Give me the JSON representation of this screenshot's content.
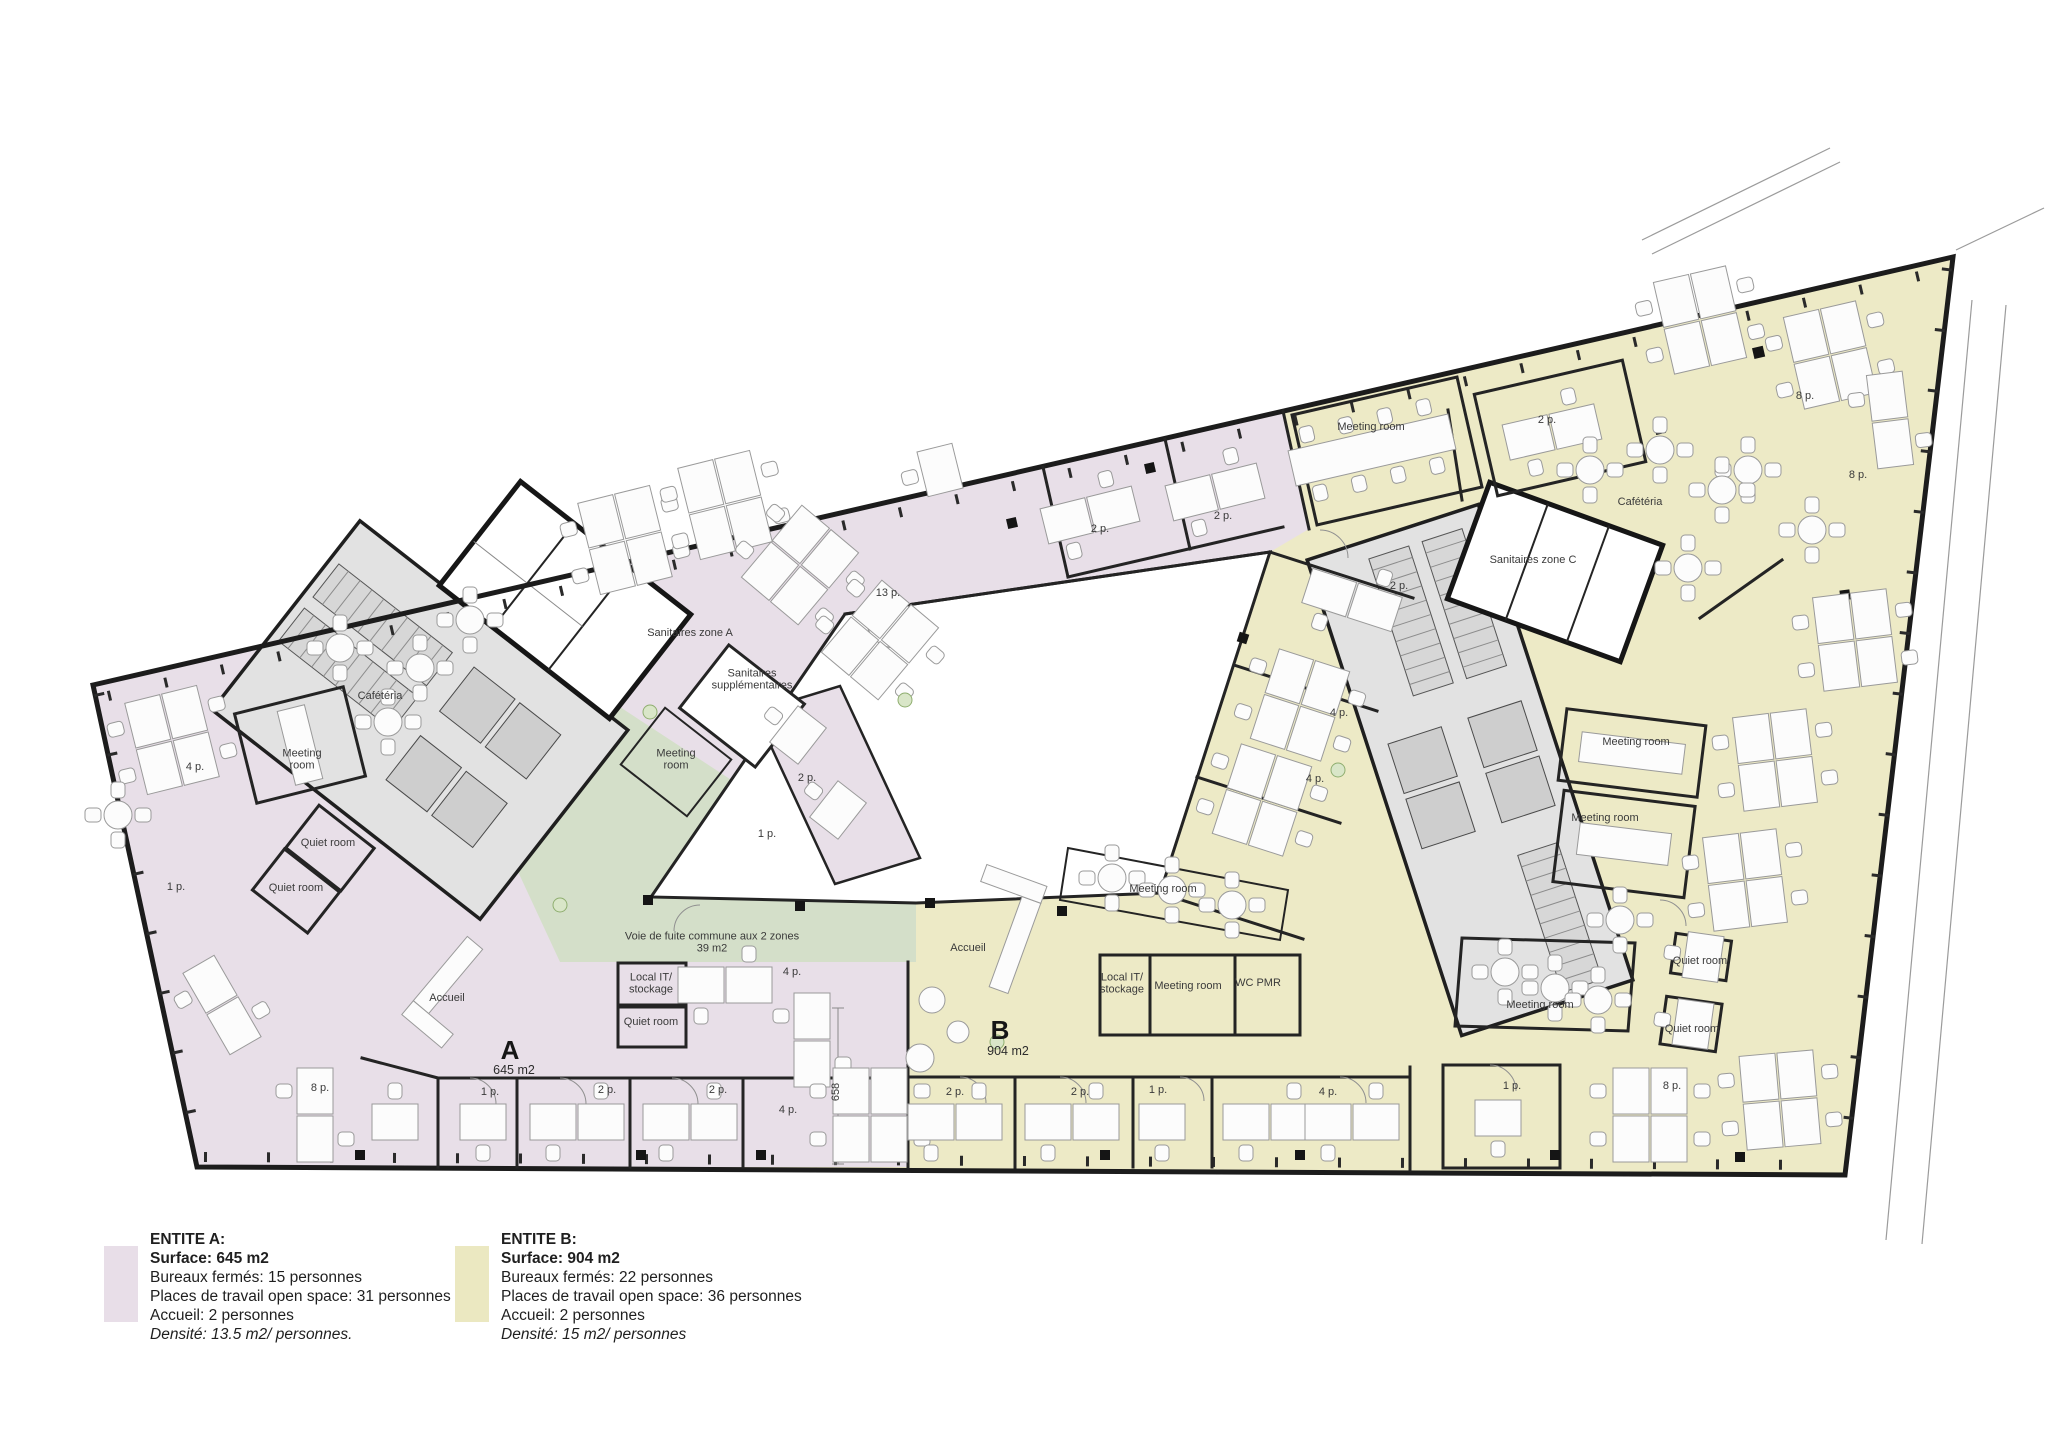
{
  "title": "Floor plan – space planning two entities",
  "colors": {
    "zone_a_fill": "#e8dfe8",
    "zone_b_fill": "#edeac6",
    "escape_corridor_fill": "#d4dfc9",
    "core_fill": "#e2e2e2",
    "wall": "#242424",
    "courtyard": "#ffffff"
  },
  "legend": {
    "a": {
      "title": "ENTITE A:",
      "surface": "Surface: 645 m2",
      "lines": [
        "Bureaux fermés: 15 personnes",
        "Places de travail open space: 31 personnes",
        "Accueil: 2 personnes"
      ],
      "density": "Densité: 13.5 m2/ personnes.",
      "swatch_color": "#e8dee8"
    },
    "b": {
      "title": "ENTITE B:",
      "surface": "Surface: 904 m2",
      "lines": [
        "Bureaux fermés: 22 personnes",
        "Places de travail open space: 36 personnes",
        "Accueil: 2 personnes"
      ],
      "density": "Densité: 15 m2/ personnes",
      "swatch_color": "#ebe8c1"
    }
  },
  "plan": {
    "zone_a_letter": "A",
    "zone_a_area": "645 m2",
    "zone_b_letter": "B",
    "zone_b_area": "904 m2",
    "labels": [
      {
        "text": "Cafétéria",
        "x": 380,
        "y": 696
      },
      {
        "text": "Meeting\nroom",
        "x": 302,
        "y": 760
      },
      {
        "text": "4 p.",
        "x": 195,
        "y": 767
      },
      {
        "text": "Quiet room",
        "x": 328,
        "y": 843
      },
      {
        "text": "Quiet room",
        "x": 296,
        "y": 888
      },
      {
        "text": "1 p.",
        "x": 176,
        "y": 887
      },
      {
        "text": "Sanitaires zone A",
        "x": 690,
        "y": 633
      },
      {
        "text": "Sanitaires\nsupplémentaires",
        "x": 752,
        "y": 680
      },
      {
        "text": "Meeting\nroom",
        "x": 676,
        "y": 760
      },
      {
        "text": "13 p.",
        "x": 888,
        "y": 593
      },
      {
        "text": "2 p.",
        "x": 1100,
        "y": 529
      },
      {
        "text": "2 p.",
        "x": 1223,
        "y": 516
      },
      {
        "text": "2 p.",
        "x": 807,
        "y": 778
      },
      {
        "text": "1 p.",
        "x": 767,
        "y": 834
      },
      {
        "text": "8 p.",
        "x": 320,
        "y": 1088
      },
      {
        "text": "Accueil",
        "x": 447,
        "y": 998
      },
      {
        "text": "Local IT/\nstockage",
        "x": 651,
        "y": 984
      },
      {
        "text": "Quiet room",
        "x": 651,
        "y": 1022
      },
      {
        "text": "4 p.",
        "x": 792,
        "y": 972
      },
      {
        "text": "A",
        "x": 510,
        "y": 1050,
        "cls": "big",
        "name": "zone-a-letter"
      },
      {
        "text": "645 m2",
        "x": 514,
        "y": 1070,
        "cls": "area",
        "name": "zone-a-area"
      },
      {
        "text": "1 p.",
        "x": 490,
        "y": 1092
      },
      {
        "text": "2 p.",
        "x": 607,
        "y": 1090
      },
      {
        "text": "2 p.",
        "x": 718,
        "y": 1090
      },
      {
        "text": "4 p.",
        "x": 788,
        "y": 1110
      },
      {
        "text": "658",
        "x": 836,
        "y": 1092,
        "rot": -90
      },
      {
        "text": "Voie de fuite commune aux 2 zones\n39 m2",
        "x": 712,
        "y": 943,
        "name": "escape-corridor-label"
      },
      {
        "text": "Meeting room",
        "x": 1371,
        "y": 427
      },
      {
        "text": "2 p.",
        "x": 1547,
        "y": 420
      },
      {
        "text": "Cafétéria",
        "x": 1640,
        "y": 502
      },
      {
        "text": "Sanitaires zone C",
        "x": 1533,
        "y": 560
      },
      {
        "text": "2 p.",
        "x": 1399,
        "y": 586
      },
      {
        "text": "4 p.",
        "x": 1339,
        "y": 713
      },
      {
        "text": "4 p.",
        "x": 1315,
        "y": 779
      },
      {
        "text": "8 p.",
        "x": 1805,
        "y": 396
      },
      {
        "text": "8 p.",
        "x": 1858,
        "y": 475
      },
      {
        "text": "Meeting room",
        "x": 1636,
        "y": 742
      },
      {
        "text": "Meeting room",
        "x": 1605,
        "y": 818
      },
      {
        "text": "Meeting room",
        "x": 1163,
        "y": 889
      },
      {
        "text": "Quiet room",
        "x": 1700,
        "y": 961
      },
      {
        "text": "Quiet room",
        "x": 1692,
        "y": 1029
      },
      {
        "text": "Accueil",
        "x": 968,
        "y": 948
      },
      {
        "text": "B",
        "x": 1000,
        "y": 1030,
        "cls": "big",
        "name": "zone-b-letter"
      },
      {
        "text": "904 m2",
        "x": 1008,
        "y": 1051,
        "cls": "area",
        "name": "zone-b-area"
      },
      {
        "text": "Local IT/\nstockage",
        "x": 1122,
        "y": 984
      },
      {
        "text": "Meeting room",
        "x": 1188,
        "y": 986
      },
      {
        "text": "WC PMR",
        "x": 1258,
        "y": 983
      },
      {
        "text": "Meeting room",
        "x": 1540,
        "y": 1005
      },
      {
        "text": "2 p.",
        "x": 955,
        "y": 1092
      },
      {
        "text": "2 p.",
        "x": 1080,
        "y": 1092
      },
      {
        "text": "1 p.",
        "x": 1158,
        "y": 1090
      },
      {
        "text": "4 p.",
        "x": 1328,
        "y": 1092
      },
      {
        "text": "1 p.",
        "x": 1512,
        "y": 1086
      },
      {
        "text": "8 p.",
        "x": 1672,
        "y": 1086
      }
    ]
  }
}
